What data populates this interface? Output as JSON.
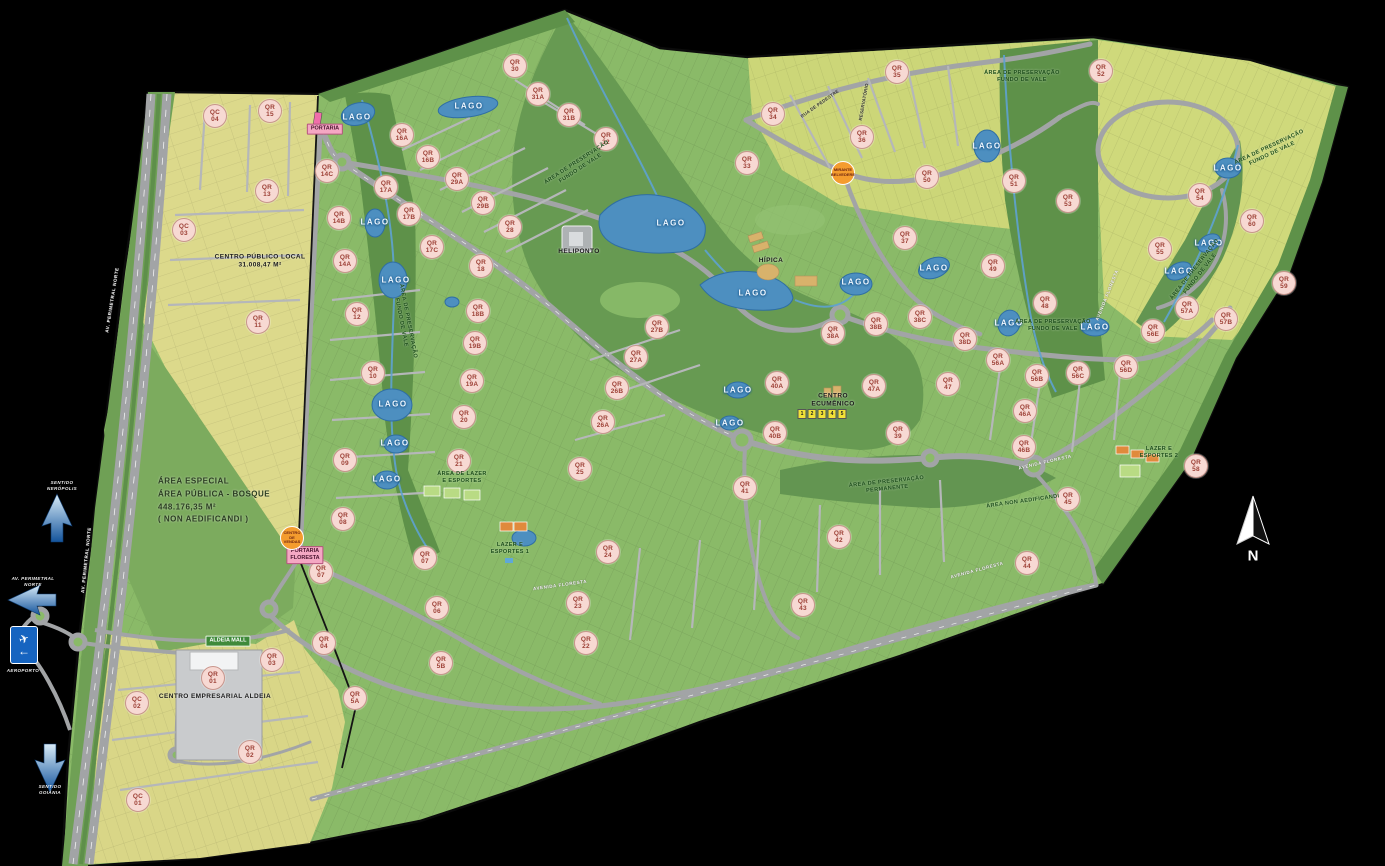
{
  "colors": {
    "bg": "#000000",
    "base-green": "#8aba68",
    "yellow-zone": "#dcd98b",
    "yellow-zone-2": "#ccd678",
    "preservation-green": "#5e9149",
    "bosque-green": "#7cab5e",
    "lake-blue": "#4d8fc0",
    "road-gray": "#a2a4a6",
    "marker-bg": "#f7d9d3",
    "marker-border": "#c8958c",
    "marker-text": "#9c3f35",
    "chip-green": "#3f8a3a",
    "chip-pink": "#f4a7c3",
    "orange-marker": "#f49c2e",
    "preserve-text": "#1e4f1c"
  },
  "compass": {
    "label": "N"
  },
  "roadside": {
    "sign_plane": "✈",
    "sign_arrow": "←",
    "sign_label": "AEROPORTO",
    "arrow_up_label": "SENTIDO\nNERÓPOLIS",
    "arrow_left_label": "AV. PERIMETRAL\nNORTE",
    "arrow_down_label": "SENTIDO\nGOIÂNIA"
  },
  "lake_label": "LAGO",
  "quadras": [
    {
      "t": "QC",
      "n": "04",
      "x": 215,
      "y": 116
    },
    {
      "t": "QR",
      "n": "15",
      "x": 270,
      "y": 111
    },
    {
      "t": "QR",
      "n": "13",
      "x": 267,
      "y": 191
    },
    {
      "t": "QC",
      "n": "03",
      "x": 184,
      "y": 230
    },
    {
      "t": "QR",
      "n": "11",
      "x": 258,
      "y": 322
    },
    {
      "t": "QR",
      "n": "14C",
      "x": 327,
      "y": 171
    },
    {
      "t": "QR",
      "n": "14B",
      "x": 339,
      "y": 218
    },
    {
      "t": "QR",
      "n": "14A",
      "x": 345,
      "y": 261
    },
    {
      "t": "QR",
      "n": "12",
      "x": 357,
      "y": 314
    },
    {
      "t": "QR",
      "n": "10",
      "x": 373,
      "y": 373
    },
    {
      "t": "QR",
      "n": "09",
      "x": 345,
      "y": 460
    },
    {
      "t": "QR",
      "n": "08",
      "x": 343,
      "y": 519
    },
    {
      "t": "QR",
      "n": "07",
      "x": 321,
      "y": 572
    },
    {
      "t": "QR",
      "n": "07",
      "x": 425,
      "y": 558
    },
    {
      "t": "QR",
      "n": "06",
      "x": 437,
      "y": 608
    },
    {
      "t": "QR",
      "n": "5B",
      "x": 441,
      "y": 663
    },
    {
      "t": "QR",
      "n": "5A",
      "x": 355,
      "y": 698
    },
    {
      "t": "QR",
      "n": "04",
      "x": 324,
      "y": 643
    },
    {
      "t": "QR",
      "n": "03",
      "x": 272,
      "y": 660
    },
    {
      "t": "QR",
      "n": "02",
      "x": 250,
      "y": 752
    },
    {
      "t": "QR",
      "n": "01",
      "x": 213,
      "y": 678
    },
    {
      "t": "QC",
      "n": "02",
      "x": 137,
      "y": 703
    },
    {
      "t": "QC",
      "n": "01",
      "x": 138,
      "y": 800
    },
    {
      "t": "QR",
      "n": "16A",
      "x": 402,
      "y": 135
    },
    {
      "t": "QR",
      "n": "16B",
      "x": 428,
      "y": 157
    },
    {
      "t": "QR",
      "n": "17A",
      "x": 386,
      "y": 187
    },
    {
      "t": "QR",
      "n": "17B",
      "x": 409,
      "y": 214
    },
    {
      "t": "QR",
      "n": "17C",
      "x": 432,
      "y": 247
    },
    {
      "t": "QR",
      "n": "29A",
      "x": 457,
      "y": 179
    },
    {
      "t": "QR",
      "n": "29B",
      "x": 483,
      "y": 203
    },
    {
      "t": "QR",
      "n": "28",
      "x": 510,
      "y": 227
    },
    {
      "t": "QR",
      "n": "30",
      "x": 515,
      "y": 66
    },
    {
      "t": "QR",
      "n": "31A",
      "x": 538,
      "y": 94
    },
    {
      "t": "QR",
      "n": "31B",
      "x": 569,
      "y": 115
    },
    {
      "t": "QR",
      "n": "32",
      "x": 606,
      "y": 139
    },
    {
      "t": "QR",
      "n": "18",
      "x": 481,
      "y": 266
    },
    {
      "t": "QR",
      "n": "18B",
      "x": 478,
      "y": 311
    },
    {
      "t": "QR",
      "n": "19B",
      "x": 475,
      "y": 343
    },
    {
      "t": "QR",
      "n": "19A",
      "x": 472,
      "y": 381
    },
    {
      "t": "QR",
      "n": "20",
      "x": 464,
      "y": 417
    },
    {
      "t": "QR",
      "n": "21",
      "x": 459,
      "y": 461
    },
    {
      "t": "QR",
      "n": "25",
      "x": 580,
      "y": 469
    },
    {
      "t": "QR",
      "n": "26A",
      "x": 603,
      "y": 422
    },
    {
      "t": "QR",
      "n": "26B",
      "x": 617,
      "y": 388
    },
    {
      "t": "QR",
      "n": "27A",
      "x": 636,
      "y": 357
    },
    {
      "t": "QR",
      "n": "27B",
      "x": 657,
      "y": 327
    },
    {
      "t": "QR",
      "n": "22",
      "x": 586,
      "y": 643
    },
    {
      "t": "QR",
      "n": "23",
      "x": 578,
      "y": 603
    },
    {
      "t": "QR",
      "n": "24",
      "x": 608,
      "y": 552
    },
    {
      "t": "QR",
      "n": "33",
      "x": 747,
      "y": 163
    },
    {
      "t": "QR",
      "n": "34",
      "x": 773,
      "y": 114
    },
    {
      "t": "QR",
      "n": "35",
      "x": 897,
      "y": 72
    },
    {
      "t": "QR",
      "n": "36",
      "x": 862,
      "y": 137
    },
    {
      "t": "QR",
      "n": "37",
      "x": 905,
      "y": 238
    },
    {
      "t": "QR",
      "n": "50",
      "x": 927,
      "y": 177
    },
    {
      "t": "QR",
      "n": "51",
      "x": 1014,
      "y": 181
    },
    {
      "t": "QR",
      "n": "52",
      "x": 1101,
      "y": 71
    },
    {
      "t": "QR",
      "n": "53",
      "x": 1068,
      "y": 201
    },
    {
      "t": "QR",
      "n": "49",
      "x": 993,
      "y": 266
    },
    {
      "t": "QR",
      "n": "48",
      "x": 1045,
      "y": 303
    },
    {
      "t": "QR",
      "n": "38A",
      "x": 833,
      "y": 333
    },
    {
      "t": "QR",
      "n": "38B",
      "x": 876,
      "y": 324
    },
    {
      "t": "QR",
      "n": "38C",
      "x": 920,
      "y": 317
    },
    {
      "t": "QR",
      "n": "38D",
      "x": 965,
      "y": 339
    },
    {
      "t": "QR",
      "n": "39",
      "x": 898,
      "y": 433
    },
    {
      "t": "QR",
      "n": "40A",
      "x": 777,
      "y": 383
    },
    {
      "t": "QR",
      "n": "40B",
      "x": 775,
      "y": 433
    },
    {
      "t": "QR",
      "n": "41",
      "x": 745,
      "y": 488
    },
    {
      "t": "QR",
      "n": "42",
      "x": 839,
      "y": 537
    },
    {
      "t": "QR",
      "n": "43",
      "x": 803,
      "y": 605
    },
    {
      "t": "QR",
      "n": "44",
      "x": 1027,
      "y": 563
    },
    {
      "t": "QR",
      "n": "45",
      "x": 1068,
      "y": 499
    },
    {
      "t": "QR",
      "n": "46A",
      "x": 1025,
      "y": 411
    },
    {
      "t": "QR",
      "n": "46B",
      "x": 1024,
      "y": 447
    },
    {
      "t": "QR",
      "n": "47A",
      "x": 874,
      "y": 386
    },
    {
      "t": "QR",
      "n": "47",
      "x": 948,
      "y": 384
    },
    {
      "t": "QR",
      "n": "54",
      "x": 1200,
      "y": 195
    },
    {
      "t": "QR",
      "n": "55",
      "x": 1160,
      "y": 249
    },
    {
      "t": "QR",
      "n": "56A",
      "x": 998,
      "y": 360
    },
    {
      "t": "QR",
      "n": "56B",
      "x": 1037,
      "y": 376
    },
    {
      "t": "QR",
      "n": "56C",
      "x": 1078,
      "y": 373
    },
    {
      "t": "QR",
      "n": "56D",
      "x": 1126,
      "y": 367
    },
    {
      "t": "QR",
      "n": "56E",
      "x": 1153,
      "y": 331
    },
    {
      "t": "QR",
      "n": "57A",
      "x": 1187,
      "y": 308
    },
    {
      "t": "QR",
      "n": "57B",
      "x": 1226,
      "y": 319
    },
    {
      "t": "QR",
      "n": "58",
      "x": 1196,
      "y": 466
    },
    {
      "t": "QR",
      "n": "59",
      "x": 1284,
      "y": 283
    },
    {
      "t": "QR",
      "n": "60",
      "x": 1252,
      "y": 221
    }
  ],
  "lakes": [
    [
      357,
      117
    ],
    [
      469,
      106
    ],
    [
      375,
      222
    ],
    [
      396,
      280
    ],
    [
      393,
      404
    ],
    [
      395,
      443
    ],
    [
      387,
      479
    ],
    [
      671,
      223
    ],
    [
      753,
      293
    ],
    [
      856,
      282
    ],
    [
      738,
      390
    ],
    [
      730,
      423
    ],
    [
      934,
      268
    ],
    [
      987,
      146
    ],
    [
      1009,
      323
    ],
    [
      1095,
      327
    ],
    [
      1228,
      168
    ],
    [
      1209,
      243
    ],
    [
      1179,
      271
    ]
  ],
  "area_labels": [
    {
      "lines": [
        "ÁREA DE PRESERVAÇÃO",
        "FUNDO DE VALE"
      ],
      "x": 579,
      "y": 166,
      "rot": -33,
      "cls": "preserve"
    },
    {
      "lines": [
        "ÁREA DE PRESERVAÇÃO",
        "FUNDO DE VALE"
      ],
      "x": 1022,
      "y": 77,
      "rot": 0,
      "cls": "preserve"
    },
    {
      "lines": [
        "ÁREA DE PRESERVAÇÃO",
        "FUNDO DE VALE"
      ],
      "x": 1053,
      "y": 326,
      "rot": 0,
      "cls": "preserve"
    },
    {
      "lines": [
        "ÁREA DE PRESERVAÇÃO",
        "FUNDO DE VALE"
      ],
      "x": 404,
      "y": 322,
      "rot": 79,
      "cls": "preserve"
    },
    {
      "lines": [
        "ÁREA DE PRESERVAÇÃO",
        "FUNDO DE VALE"
      ],
      "x": 1271,
      "y": 151,
      "rot": -25,
      "cls": "preserve"
    },
    {
      "lines": [
        "ÁREA DE PRESERVAÇÃO",
        "FUNDO DE VALE"
      ],
      "x": 1198,
      "y": 272,
      "rot": -52,
      "cls": "preserve"
    },
    {
      "lines": [
        "ÁREA DE PRESERVAÇÃO",
        "PERMANENTE"
      ],
      "x": 887,
      "y": 486,
      "rot": -6,
      "cls": "preserve"
    },
    {
      "lines": [
        "ÁREA NON AEDIFICANDI"
      ],
      "x": 1023,
      "y": 502,
      "rot": -8,
      "cls": "preserve"
    },
    {
      "lines": [
        "ÁREA DE LAZER",
        "E ESPORTES"
      ],
      "x": 462,
      "y": 478,
      "rot": 0,
      "cls": "preserve"
    },
    {
      "lines": [
        "LAZER E",
        "ESPORTES 1"
      ],
      "x": 510,
      "y": 549,
      "rot": 0,
      "cls": "preserve"
    },
    {
      "lines": [
        "LAZER E",
        "ESPORTES 2"
      ],
      "x": 1159,
      "y": 453,
      "rot": 0,
      "cls": "preserve"
    },
    {
      "lines": [
        "HELIPONTO"
      ],
      "x": 579,
      "y": 252,
      "rot": 0,
      "cls": "dark"
    },
    {
      "lines": [
        "HÍPICA"
      ],
      "x": 771,
      "y": 261,
      "rot": 0,
      "cls": "dark"
    },
    {
      "lines": [
        "CENTRO",
        "ECUMÊNICO"
      ],
      "x": 833,
      "y": 401,
      "rot": 0,
      "cls": "dark"
    },
    {
      "lines": [
        "CENTRO PÚBLICO LOCAL",
        "31.008,47 M²"
      ],
      "x": 260,
      "y": 262,
      "rot": 0,
      "cls": "dark"
    },
    {
      "lines": [
        "CENTRO EMPRESARIAL ALDEIA"
      ],
      "x": 215,
      "y": 697,
      "rot": 0,
      "cls": "dark"
    },
    {
      "lines": [
        "ÁREA ESPECIAL",
        "ÁREA PÚBLICA - BOSQUE",
        "448.176,35 M²",
        "( NON AEDIFICANDI )"
      ],
      "x": 158,
      "y": 501,
      "rot": 0,
      "cls": "special"
    },
    {
      "lines": [
        "RUA DE PEDESTRE"
      ],
      "x": 820,
      "y": 104,
      "rot": -35,
      "cls": "tiny"
    },
    {
      "lines": [
        "RESERVATÓRIO"
      ],
      "x": 864,
      "y": 102,
      "rot": -80,
      "cls": "tiny"
    }
  ],
  "chips": [
    {
      "text": "ALDEIA MALL",
      "x": 228,
      "y": 641,
      "style": "green"
    },
    {
      "text": "PORTARIA",
      "x": 325,
      "y": 129,
      "style": "pink"
    },
    {
      "text": "PORTARIA\nFLORESTA",
      "x": 305,
      "y": 555,
      "style": "pink"
    }
  ],
  "orange_markers": [
    {
      "lines": [
        "CENTRO DE",
        "VENDAS"
      ],
      "x": 292,
      "y": 538
    },
    {
      "lines": [
        "MIRANTE",
        "BELVEDERE"
      ],
      "x": 843,
      "y": 173
    }
  ],
  "ecumenico_boxes": [
    "1",
    "2",
    "3",
    "4",
    "5"
  ],
  "street_labels": [
    {
      "text": "AVENIDA FLORESTA",
      "x": 1107,
      "y": 295,
      "rot": -68
    },
    {
      "text": "AVENIDA FLORESTA",
      "x": 1045,
      "y": 462,
      "rot": -13
    },
    {
      "text": "AVENIDA FLORESTA",
      "x": 977,
      "y": 570,
      "rot": -15
    },
    {
      "text": "AVENIDA FLORESTA",
      "x": 560,
      "y": 585,
      "rot": -8
    },
    {
      "text": "AV. PERIMETRAL NORTE",
      "x": 112,
      "y": 300,
      "rot": -81
    },
    {
      "text": "AV. PERIMETRAL NORTE",
      "x": 86,
      "y": 560,
      "rot": -84
    }
  ]
}
